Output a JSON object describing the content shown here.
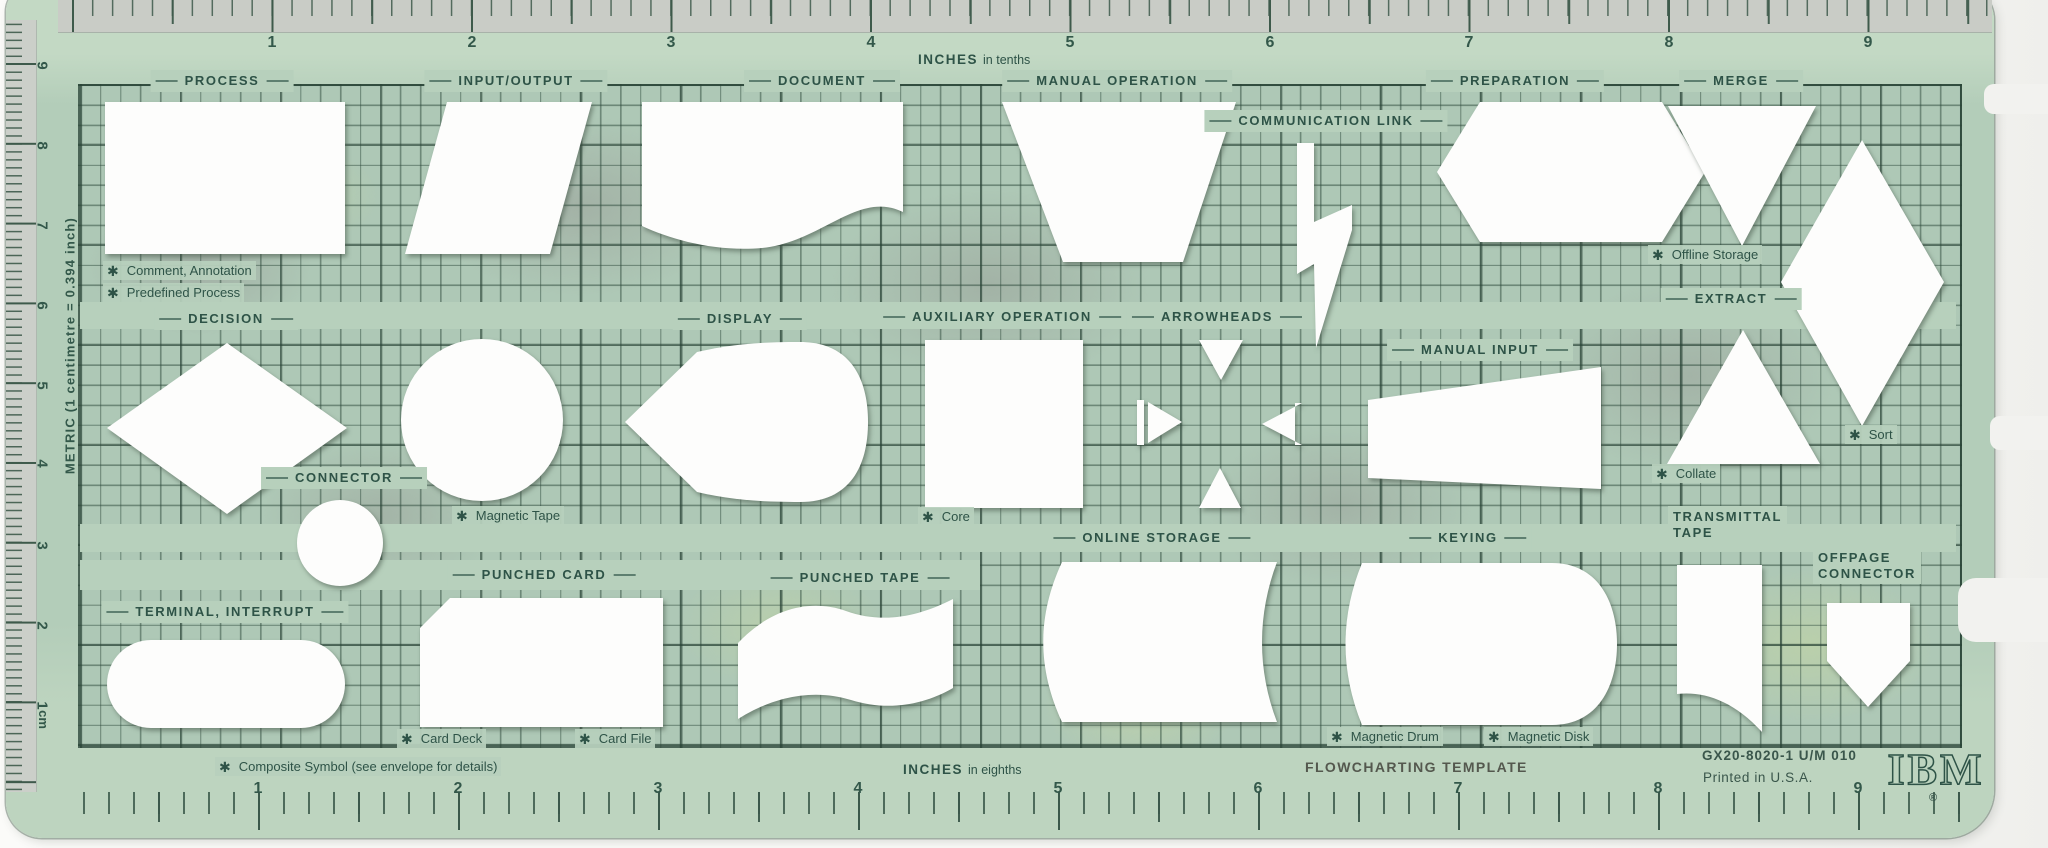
{
  "star": "✱",
  "colors": {
    "plastic": "#b7d0bc",
    "plastic_band": "#c3d9c4",
    "grid_line": "#3c5c4c",
    "ink": "#2e5347",
    "cutout": "#fdfdfc"
  },
  "rulers": {
    "top": {
      "unit_bold": "INCHES",
      "unit_rest": "in tenths",
      "numbers": [
        "1",
        "2",
        "3",
        "4",
        "5",
        "6",
        "7",
        "8",
        "9"
      ]
    },
    "bottom": {
      "unit_bold": "INCHES",
      "unit_rest": "in eighths",
      "numbers": [
        "1",
        "2",
        "3",
        "4",
        "5",
        "6",
        "7",
        "8",
        "9"
      ]
    },
    "left": {
      "caption": "METRIC (1 centimetre = 0.394 inch)",
      "unit": "cm",
      "numbers": [
        "9",
        "8",
        "7",
        "6",
        "5",
        "4",
        "3",
        "2",
        "1"
      ]
    }
  },
  "labels": {
    "process": "PROCESS",
    "input_output": "INPUT/OUTPUT",
    "document": "DOCUMENT",
    "manual_operation": "MANUAL OPERATION",
    "communication_link": "COMMUNICATION LINK",
    "preparation": "PREPARATION",
    "merge": "MERGE",
    "offline_storage": "Offline Storage",
    "extract": "EXTRACT",
    "comment_annotation": "Comment, Annotation",
    "predefined_process": "Predefined Process",
    "decision": "DECISION",
    "display": "DISPLAY",
    "auxiliary_operation": "AUXILIARY OPERATION",
    "arrowheads": "ARROWHEADS",
    "manual_input": "MANUAL INPUT",
    "sort": "Sort",
    "collate": "Collate",
    "connector": "CONNECTOR",
    "magnetic_tape": "Magnetic Tape",
    "core": "Core",
    "online_storage": "ONLINE STORAGE",
    "keying": "KEYING",
    "transmittal_tape": "TRANSMITTAL\nTAPE",
    "offpage_connector": "OFFPAGE\nCONNECTOR",
    "punched_card": "PUNCHED CARD",
    "punched_tape": "PUNCHED TAPE",
    "terminal_interrupt": "TERMINAL, INTERRUPT",
    "card_deck": "Card Deck",
    "card_file": "Card File",
    "magnetic_drum": "Magnetic Drum",
    "magnetic_disk": "Magnetic Disk",
    "composite_symbol": "Composite Symbol (see envelope for details)"
  },
  "footer": {
    "part_number": "GX20-8020-1   U/M 010",
    "printed": "Printed in U.S.A.",
    "product_title": "FLOWCHARTING TEMPLATE",
    "brand": "IBM",
    "registered": "®"
  }
}
